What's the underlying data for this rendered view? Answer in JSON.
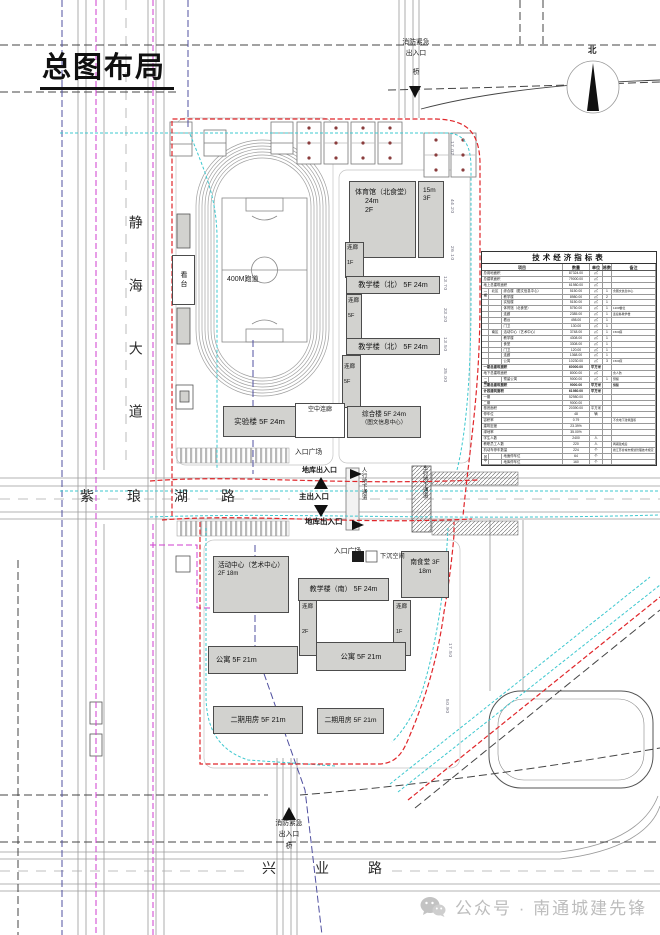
{
  "page": {
    "title": "总图布局"
  },
  "roads": {
    "west": "静海大道",
    "middle": "紫琅湖路",
    "south": "兴业路"
  },
  "annotations": {
    "fire_top": "消防紧急\n出入口",
    "bridge_top": "桥",
    "fire_bottom": "消防紧急\n出入口",
    "bridge_bottom": "桥",
    "track": "400M跑道",
    "plaza_north": "入口广场",
    "garage_exit_north": "地库出入口",
    "main_entrance": "主出入口",
    "garage_exit_south": "地库出入口",
    "plaza_south": "入口广场",
    "sunken_space": "下沉空间",
    "ped_tunnel": "人行地下通道",
    "veh_tunnel": "车行地下通道",
    "north_label": "北"
  },
  "buildings": {
    "gym": {
      "name": "体育馆（北食堂）",
      "sub": [
        "24m",
        "2F"
      ]
    },
    "gym_annex": {
      "sub": [
        "15m",
        "3F"
      ]
    },
    "corridor_n1": {
      "name": "连廊",
      "sub": [
        "1F"
      ]
    },
    "teach_north_1": {
      "name": "教学楼（北） 5F 24m"
    },
    "corridor_n2": {
      "name": "连廊",
      "sub": [
        "5F"
      ]
    },
    "teach_north_2": {
      "name": "教学楼（北） 5F 24m"
    },
    "corridor_n3": {
      "name": "连廊",
      "sub": [
        "5F"
      ]
    },
    "lab": {
      "name": "实验楼 5F 24m"
    },
    "sky_corridor": {
      "name": "空中连廊"
    },
    "complex": {
      "name": "综合楼 5F 24m",
      "sub": [
        "（图文信息中心）"
      ]
    },
    "activity_center": {
      "name": "活动中心（艺术中心）",
      "sub": [
        "2F 18m"
      ]
    },
    "teach_south": {
      "name": "教学楼（南） 5F 24m"
    },
    "canteen_south": {
      "name": "南食堂 3F",
      "sub": [
        "18m"
      ]
    },
    "corridor_s1": {
      "name": "连廊",
      "sub": [
        "2F"
      ]
    },
    "corridor_s2": {
      "name": "连廊",
      "sub": [
        "1F"
      ]
    },
    "apartment_1": {
      "name": "公寓 5F 21m"
    },
    "apartment_2": {
      "name": "公寓 5F 21m"
    },
    "phase2_1": {
      "name": "二期用房 5F 21m"
    },
    "phase2_2": {
      "name": "二期用房 5F 21m"
    },
    "stand": {
      "name": "看台"
    }
  },
  "dimensions": [
    "17.02",
    "44.20",
    "26.10",
    "13.70",
    "33.20",
    "13.50",
    "35.00",
    "17.50",
    "50.90"
  ],
  "table": {
    "title": "技术经济指标表",
    "headers": [
      "项目",
      "数量",
      "单位",
      "栋数",
      "备注"
    ],
    "rows": [
      {
        "m": 1,
        "n": "总用地面积",
        "q": "87324.00",
        "u": "㎡"
      },
      {
        "m": 1,
        "n": "总建筑面积",
        "q": "79000.00",
        "u": "㎡"
      },
      {
        "m": 1,
        "n": "地上总建筑面积",
        "q": "61980.00",
        "u": "㎡"
      },
      {
        "g1": "一期",
        "g2": "北区",
        "n": "综合楼（图文信息中心）",
        "q": "5150.00",
        "u": "㎡",
        "c": "1",
        "r": "含图文信息中心"
      },
      {
        "n": "教学楼",
        "q": "8980.00",
        "u": "㎡",
        "c": "2"
      },
      {
        "n": "实验楼",
        "q": "5150.00",
        "u": "㎡",
        "c": "1"
      },
      {
        "n": "体育馆（北食堂）",
        "q": "5750.00",
        "u": "㎡",
        "c": "1",
        "r": "1200餐位"
      },
      {
        "n": "连廊",
        "q": "2385.00",
        "u": "㎡",
        "c": "1",
        "r": "连接各教学楼"
      },
      {
        "n": "看台",
        "q": "498.00",
        "u": "㎡",
        "c": "1"
      },
      {
        "n": "门卫",
        "q": "130.00",
        "u": "㎡",
        "c": "1"
      },
      {
        "g2": "南区",
        "n": "活动中心（艺术中心）",
        "q": "3748.00",
        "u": "㎡",
        "c": "1",
        "r": "1500座"
      },
      {
        "n": "教学楼",
        "q": "4308.00",
        "u": "㎡",
        "c": "1"
      },
      {
        "n": "食堂",
        "q": "3308.00",
        "u": "㎡",
        "c": "1"
      },
      {
        "n": "门卫",
        "q": "120.00",
        "u": "㎡",
        "c": "1"
      },
      {
        "n": "连廊",
        "q": "1368.00",
        "u": "㎡",
        "c": "1"
      },
      {
        "n": "公寓",
        "q": "10230.00",
        "u": "㎡",
        "c": "3",
        "r": "1500床"
      },
      {
        "m": 1,
        "b": 1,
        "n": "一期总建筑面积",
        "q": "60000.00",
        "u": "平方米"
      },
      {
        "m": 1,
        "n": "地下总建筑面积",
        "q": "8000.00",
        "u": "㎡",
        "r": "含人防"
      },
      {
        "g1": "二期",
        "n": "预留公寓",
        "q": "9000.00",
        "u": "㎡",
        "c": "1",
        "r": "预留"
      },
      {
        "m": 1,
        "b": 1,
        "n": "二期总建筑面积",
        "q": "9000.00",
        "u": "平方米",
        "r": "预留"
      },
      {
        "m": 1,
        "b": 1,
        "n": "计容建筑面积",
        "q": "61980.00",
        "u": "平方米"
      },
      {
        "m": 1,
        "n": "一期",
        "q": "52980.00"
      },
      {
        "m": 1,
        "n": "二期",
        "q": "9000.00"
      },
      {
        "m": 1,
        "n": "基底面积",
        "q": "20390.00",
        "u": "平方米"
      },
      {
        "m": 1,
        "n": "停车位",
        "q": "48",
        "u": "辆"
      },
      {
        "m": 1,
        "n": "容积率",
        "q": "0.79",
        "r": "不含地下建筑面积"
      },
      {
        "m": 1,
        "n": "建筑密度",
        "q": "23.39%"
      },
      {
        "m": 1,
        "n": "绿地率",
        "q": "35.00%"
      },
      {
        "m": 1,
        "n": "学生人数",
        "q": "2400",
        "u": "人"
      },
      {
        "m": 1,
        "n": "教职员工人数",
        "q": "220",
        "u": "人",
        "r": "两期建成后"
      },
      {
        "m": 1,
        "n": "机动车停车数量",
        "q": "224",
        "u": "个",
        "r": "按江苏省城市规划管理技术规定（2023版）"
      },
      {
        "g1": "其中",
        "n": "地面停车位",
        "q": "64",
        "u": "个"
      },
      {
        "n": "地库停车位",
        "q": "160",
        "u": "个"
      }
    ]
  },
  "watermark": {
    "text": "公众号 · 南通城建先锋"
  },
  "colors": {
    "boundary_red": "#e0262a",
    "green_line_cyan": "#3ec8cf",
    "control_magenta": "#cf3ecf",
    "control_blue": "#5050a0",
    "building_fill": "#d2d2cf"
  }
}
